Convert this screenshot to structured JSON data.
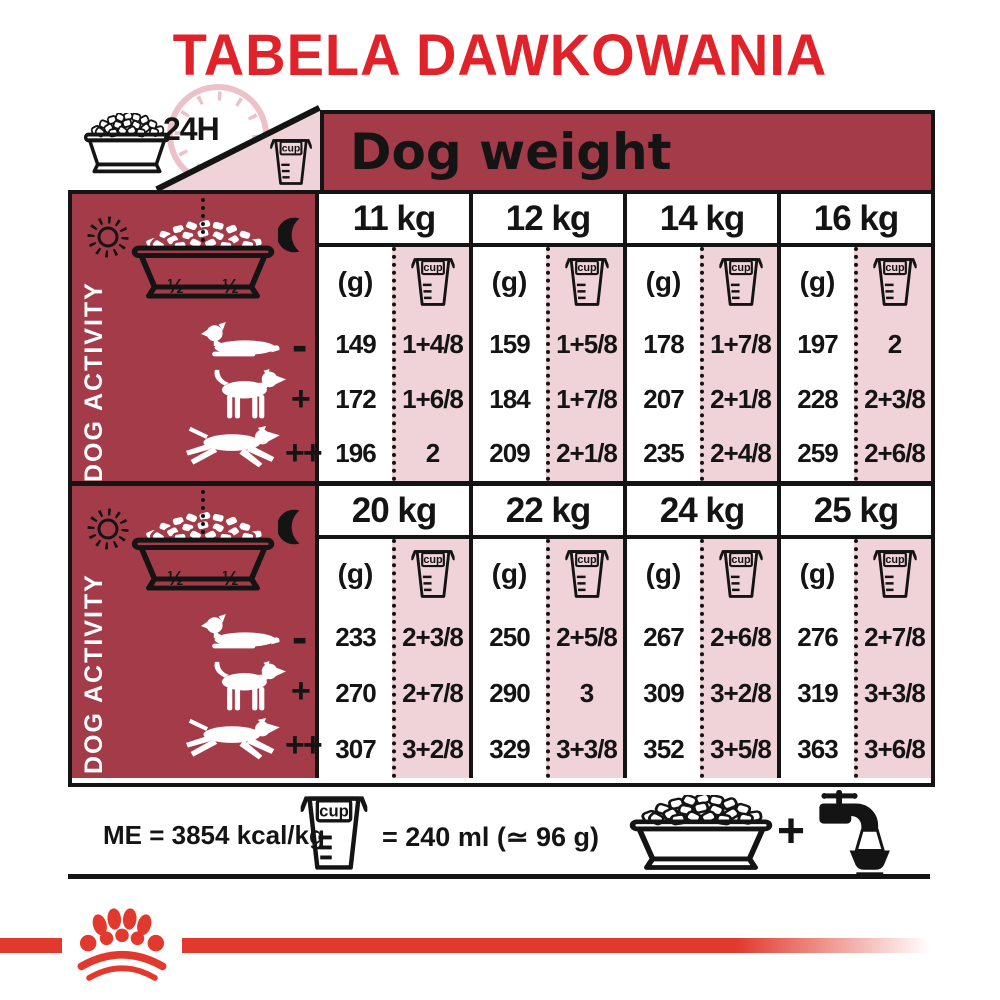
{
  "title": "TABELA DAWKOWANIA",
  "colors": {
    "accent_red": "#e0232a",
    "dark_red": "#a33b49",
    "pink": "#f0d3d8",
    "black": "#141414",
    "logo_red": "#e1392d"
  },
  "header": {
    "clock_label": "24H",
    "dog_weight_label": "Dog weight"
  },
  "labels": {
    "cup": "cup",
    "grams_unit": "(g)",
    "activity": "DOG ACTIVITY",
    "half": "½",
    "low": "-",
    "medium": "+",
    "high": "++"
  },
  "activity_levels": [
    "-",
    "+",
    "++"
  ],
  "sections": [
    {
      "columns": [
        {
          "weight": "11 kg",
          "grams": [
            "149",
            "172",
            "196"
          ],
          "cups": [
            "1+4/8",
            "1+6/8",
            "2"
          ]
        },
        {
          "weight": "12 kg",
          "grams": [
            "159",
            "184",
            "209"
          ],
          "cups": [
            "1+5/8",
            "1+7/8",
            "2+1/8"
          ]
        },
        {
          "weight": "14 kg",
          "grams": [
            "178",
            "207",
            "235"
          ],
          "cups": [
            "1+7/8",
            "2+1/8",
            "2+4/8"
          ]
        },
        {
          "weight": "16 kg",
          "grams": [
            "197",
            "228",
            "259"
          ],
          "cups": [
            "2",
            "2+3/8",
            "2+6/8"
          ]
        }
      ]
    },
    {
      "columns": [
        {
          "weight": "20 kg",
          "grams": [
            "233",
            "270",
            "307"
          ],
          "cups": [
            "2+3/8",
            "2+7/8",
            "3+2/8"
          ]
        },
        {
          "weight": "22 kg",
          "grams": [
            "250",
            "290",
            "329"
          ],
          "cups": [
            "2+5/8",
            "3",
            "3+3/8"
          ]
        },
        {
          "weight": "24 kg",
          "grams": [
            "267",
            "309",
            "352"
          ],
          "cups": [
            "2+6/8",
            "3+2/8",
            "3+5/8"
          ]
        },
        {
          "weight": "25 kg",
          "grams": [
            "276",
            "319",
            "363"
          ],
          "cups": [
            "2+7/8",
            "3+3/8",
            "3+6/8"
          ]
        }
      ]
    }
  ],
  "footer": {
    "energy": "ME = 3854 kcal/kg",
    "cup_equiv": "= 240 ml (≃ 96 g)",
    "plus": "+"
  },
  "icons": {
    "clock": "24h-clock",
    "bowl": "kibble-bowl",
    "cup": "measuring-cup",
    "sun": "sun",
    "moon": "moon",
    "dog_low": "resting-dog",
    "dog_medium": "standing-dog",
    "dog_high": "running-dog",
    "tap": "water-tap",
    "logo": "crown-paw-logo"
  }
}
